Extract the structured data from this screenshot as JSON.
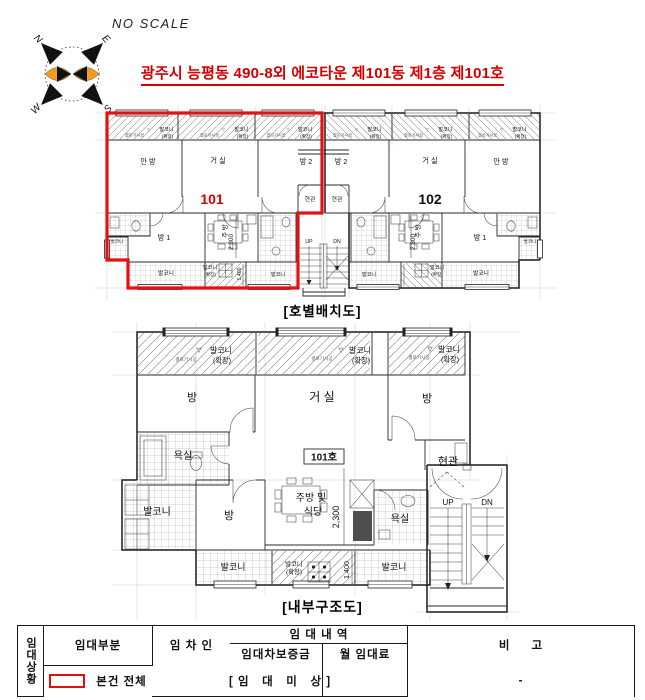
{
  "colors": {
    "accent_red": "#d40000",
    "outline_red": "#e31212",
    "compass_orange": "#f09d20",
    "line": "#1a1a1a"
  },
  "header": {
    "no_scale": "NO SCALE",
    "title": "광주시 능평동 490-8외 에코타운 제101동 제1층 제101호",
    "compass": {
      "n": "N",
      "e": "E",
      "s": "S",
      "w": "W"
    }
  },
  "labels": {
    "balcony": "발코니",
    "ext": "(확장)",
    "tri": "▽",
    "ext_note": "결로기시공",
    "anbang": "안 방",
    "geosil": "거 실",
    "bang": "방",
    "bang1": "방 1",
    "bang2": "방 2",
    "hyeongwan": "현관",
    "jubang": "주 방",
    "kitchen_line1": "주방 및",
    "kitchen_line2": "식당",
    "yoksil": "욕실",
    "up": "UP",
    "dn": "DN",
    "dim_2300": "2,300",
    "dim_1400": "1,400"
  },
  "plan1": {
    "caption": "[호별배치도]",
    "unit101_no": "101",
    "unit102_no": "102"
  },
  "plan2": {
    "caption": "[내부구조도]",
    "unit_label": "101호"
  },
  "table": {
    "row_header": "임대상황",
    "col_part": "임대부분",
    "col_tenant": "임 차 인",
    "col_detail": "임 대 내 역",
    "col_deposit": "임대차보증금",
    "col_monthly": "월 임대료",
    "col_note": "비     고",
    "data_part": "본건 전체",
    "data_value": "[ 임   대   미   상 ]",
    "data_note": "-"
  }
}
